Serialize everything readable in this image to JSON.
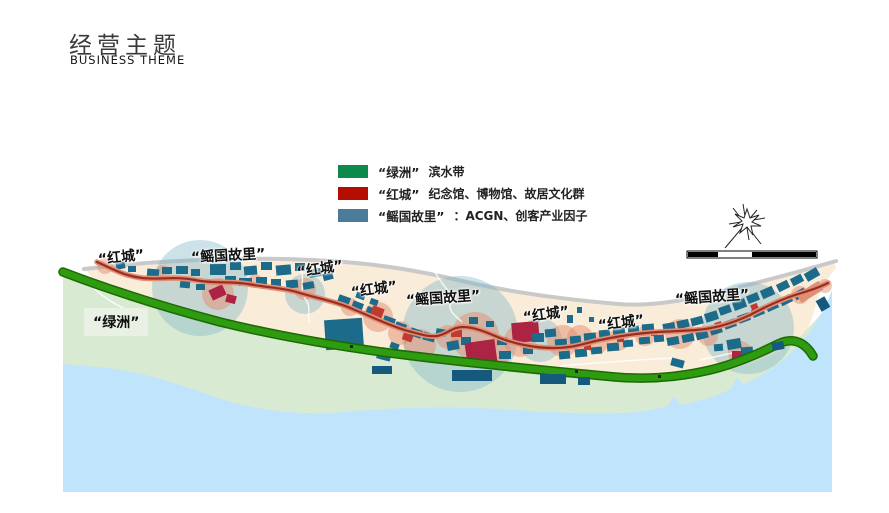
{
  "header": {
    "title": "经营主题",
    "subtitle": "BUSINESS THEME"
  },
  "legend": {
    "items": [
      {
        "name": "“绿洲”",
        "desc": "滨水带",
        "color": "#0c8a4b"
      },
      {
        "name": "“红城”",
        "desc": "纪念馆、博物馆、故居文化群",
        "color": "#b60d02"
      },
      {
        "name": "“鳐国故里”",
        "desc": "：ACGN、创客产业因子",
        "color": "#4a7b98"
      }
    ]
  },
  "map": {
    "labels": [
      {
        "text": "“红城”",
        "x": 98,
        "y": 249,
        "rot": -6,
        "boxed": false
      },
      {
        "text": "“鳐国故里”",
        "x": 191,
        "y": 247,
        "rot": -3,
        "boxed": false
      },
      {
        "text": "“红城”",
        "x": 297,
        "y": 262,
        "rot": -9,
        "boxed": false
      },
      {
        "text": "“红城”",
        "x": 351,
        "y": 282,
        "rot": -8,
        "boxed": false
      },
      {
        "text": "“鳐国故里”",
        "x": 406,
        "y": 290,
        "rot": -4,
        "boxed": false
      },
      {
        "text": "“红城”",
        "x": 523,
        "y": 307,
        "rot": -8,
        "boxed": false
      },
      {
        "text": "“红城”",
        "x": 598,
        "y": 315,
        "rot": -7,
        "boxed": false
      },
      {
        "text": "“鳐国故里”",
        "x": 675,
        "y": 289,
        "rot": -4,
        "boxed": false
      },
      {
        "text": "“绿洲”",
        "x": 84,
        "y": 308,
        "rot": 0,
        "boxed": true
      }
    ],
    "colors": {
      "water": "#c0e4fb",
      "shore_green": "#d9ead2",
      "land": "#f9ecd9",
      "top_edge_gray": "#c9c9c9",
      "green_belt": "#2f9b10",
      "green_belt_dark": "#1b6b03",
      "road_casing": "#dd8f78",
      "road_core": "#9c2d1e",
      "building_teal": "#1c6b8a",
      "building_navy": "#155a7c",
      "building_red": "#c03a30",
      "building_crimson": "#ac2344",
      "building_salmon": "#df8f74",
      "dot_dark": "#15281c",
      "zone_circle_blue": "#7fb6c9",
      "node_circle_salmon": "#e28663"
    }
  }
}
